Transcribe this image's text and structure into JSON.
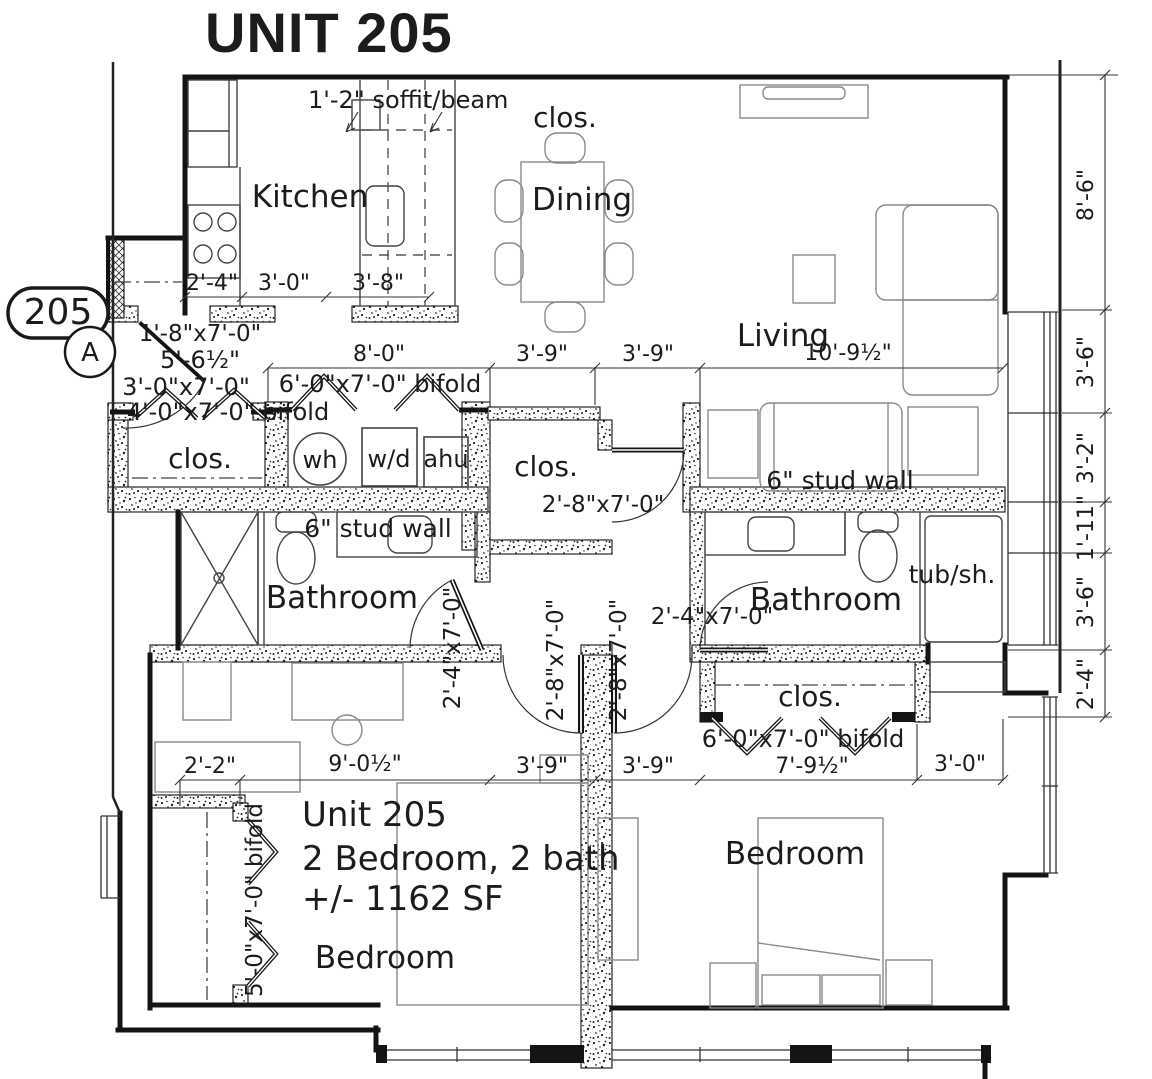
{
  "title": "UNIT 205",
  "tag": {
    "number": "205",
    "letter": "A"
  },
  "rooms": {
    "kitchen": "Kitchen",
    "dining": "Dining",
    "living": "Living",
    "closet": "clos.",
    "bathroom_left": "Bathroom",
    "bathroom_right": "Bathroom",
    "bedroom_left": "Bedroom",
    "bedroom_right": "Bedroom",
    "tub": "tub/sh."
  },
  "appliances": {
    "water_heater": "wh",
    "washer_dryer": "w/d",
    "air_handler": "ahu"
  },
  "annotations": {
    "soffit": "1'-2\" soffit/beam",
    "stud_wall": "6\" stud wall",
    "info_line1": "Unit 205",
    "info_line2": "2 Bedroom, 2 bath",
    "info_line3": "+/- 1162 SF"
  },
  "doors": {
    "entry": "1'-8\"x7'-0\"",
    "entry_width": "5'-6½\"",
    "unit_entry": "3'-0\"x7'-0\"",
    "coat_closet_bifold": "4'-0\"x7'-0\" bifold",
    "laundry_bifold": "6'-0\"x7'-0\" bifold",
    "hall_closet": "2'-8\"x7'-0\"",
    "bath_left": "2'-4\"x7'-0\"",
    "bed_left": "2'-8\"x7'-0\"",
    "bed_right": "2'-8\"x7'-0\"",
    "bath_right": "2'-4\"x7'-0\"",
    "closet_right_bifold": "6'-0\"x7'-0\" bifold",
    "bed_left_closet_bifold": "5'-0\"x7'-0\" bifold"
  },
  "dimensions": {
    "kitchen_row": [
      "2'-4\"",
      "3'-0\"",
      "3'-8\""
    ],
    "mid_row": [
      "8'-0\"",
      "3'-9\"",
      "3'-9\"",
      "10'-9½\""
    ],
    "right_column": [
      "8'-6\"",
      "3'-6\"",
      "3'-2\"",
      "1'-11\"",
      "3'-6\"",
      "2'-4\""
    ],
    "bottom_row": [
      "2'-2\"",
      "9'-0½\"",
      "3'-9\"",
      "3'-9\"",
      "7'-9½\"",
      "3'-0\""
    ]
  }
}
